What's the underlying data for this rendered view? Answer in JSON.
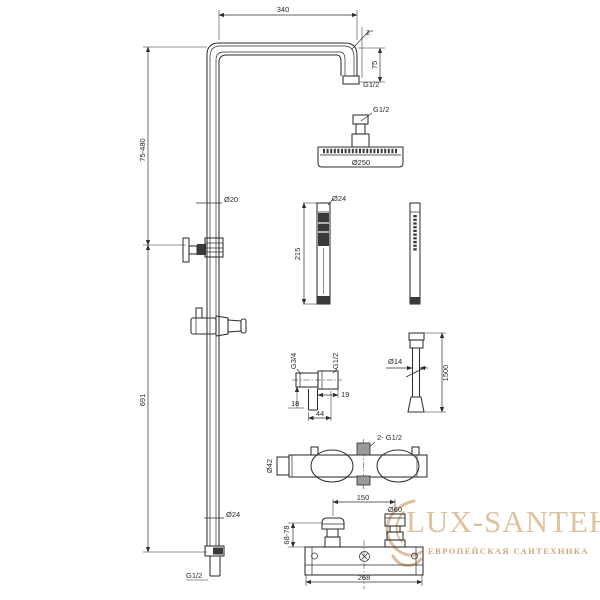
{
  "watermark": {
    "title": "LUX-SANTEH",
    "subtitle": "ЕВРОПЕЙСКАЯ САНТЕХНИКА",
    "title_color": "#d9bd93",
    "subtitle_color": "#cfa477"
  },
  "colors": {
    "line": "#2f2f2f",
    "background": "#ffffff",
    "dark_fill": "#3a3a3a"
  },
  "dimensions": {
    "arm_width": "340",
    "arm_angle": "2°",
    "arm_drop": "75",
    "arm_outlet_thread": "G1/2",
    "head_thread": "G1/2",
    "head_diameter": "Ø250",
    "upper_column_height": "75-480",
    "column_tube_diameter": "Ø20",
    "lower_column_height": "691",
    "column_bottom_diameter": "Ø24",
    "column_bottom_thread": "G1/2",
    "handshower_diameter": "Ø24",
    "handshower_length": "215",
    "hose_diameter": "Ø14",
    "hose_length": "1500",
    "union_thread_top": "G3/4",
    "union_thread_side": "G1/2",
    "union_offset": "19",
    "union_height": "18",
    "union_width": "44",
    "mixer_connections": "2- G1/2",
    "mixer_body_diameter": "Ø42",
    "mixer_centers_distance": "150",
    "mixer_nut_diameter": "Ø60",
    "mixer_height_range": "68-78",
    "mixer_width": "268"
  }
}
